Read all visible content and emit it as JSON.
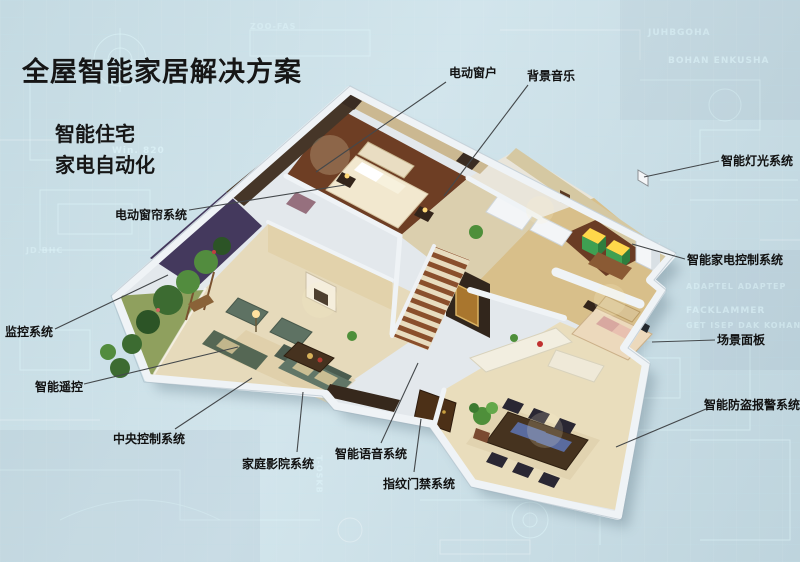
{
  "title": {
    "text": "全屋智能家居解决方案"
  },
  "subtitle": {
    "line1": "智能住宅",
    "line2": "家电自动化"
  },
  "colors": {
    "background": "#cbe0e8",
    "text": "#161616",
    "callout_line": "#44484b",
    "house_wall_white": "#eff3f6",
    "wood_floor": "#6e3e24",
    "marble_floor": "#e6dabb",
    "sofa_green": "#5e7263",
    "appliance_green": "#3fa052",
    "blueprint_line": "#dff6fa"
  },
  "callouts": [
    {
      "id": "electric-window",
      "label": "电动窗户",
      "label_x": 449,
      "label_y": 64,
      "line": [
        446,
        82,
        316,
        172
      ]
    },
    {
      "id": "background-music",
      "label": "背景音乐",
      "label_x": 527,
      "label_y": 67,
      "line": [
        528,
        85,
        444,
        196
      ]
    },
    {
      "id": "smart-lighting-system",
      "label": "智能灯光系统",
      "label_x": 721,
      "label_y": 152,
      "line": [
        719,
        161,
        644,
        177
      ]
    },
    {
      "id": "smart-appliance-control",
      "label": "智能家电控制系统",
      "label_x": 687,
      "label_y": 251,
      "line": [
        685,
        259,
        632,
        244
      ]
    },
    {
      "id": "scene-panel",
      "label": "场景面板",
      "label_x": 717,
      "label_y": 331,
      "line": [
        715,
        340,
        652,
        342
      ]
    },
    {
      "id": "anti-theft-alarm",
      "label": "智能防盗报警系统",
      "label_x": 704,
      "label_y": 396,
      "line": [
        706,
        409,
        616,
        447
      ]
    },
    {
      "id": "electric-curtain-system",
      "label": "电动窗帘系统",
      "label_x": 115,
      "label_y": 206,
      "line": [
        189,
        210,
        345,
        185
      ]
    },
    {
      "id": "monitoring-system",
      "label": "监控系统",
      "label_x": 5,
      "label_y": 323,
      "line": [
        55,
        329,
        168,
        275
      ]
    },
    {
      "id": "smart-remote-control",
      "label": "智能遥控",
      "label_x": 35,
      "label_y": 378,
      "line": [
        84,
        384,
        238,
        347
      ]
    },
    {
      "id": "central-control-system",
      "label": "中央控制系统",
      "label_x": 113,
      "label_y": 430,
      "line": [
        175,
        429,
        252,
        378
      ]
    },
    {
      "id": "home-theater-system",
      "label": "家庭影院系统",
      "label_x": 242,
      "label_y": 455,
      "line": [
        297,
        452,
        303,
        392
      ]
    },
    {
      "id": "smart-voice-system",
      "label": "智能语音系统",
      "label_x": 335,
      "label_y": 445,
      "line": [
        381,
        443,
        418,
        363
      ]
    },
    {
      "id": "fingerprint-access",
      "label": "指纹门禁系统",
      "label_x": 383,
      "label_y": 475,
      "line": [
        414,
        472,
        421,
        419
      ]
    }
  ],
  "background": {
    "annotations": [
      {
        "t": "Win. 820",
        "x": 112,
        "y": 146,
        "s": 9,
        "o": 0.55,
        "r": 0
      },
      {
        "t": "JUHBGOHA",
        "x": 648,
        "y": 28,
        "s": 9,
        "o": 0.45,
        "r": 0
      },
      {
        "t": "BOHAN ENKUSHA",
        "x": 668,
        "y": 56,
        "s": 9,
        "o": 0.5,
        "r": 0
      },
      {
        "t": "ADAPTEL ADAPTEP",
        "x": 686,
        "y": 282,
        "s": 8,
        "o": 0.45,
        "r": 0
      },
      {
        "t": "FACKLAMMER",
        "x": 686,
        "y": 306,
        "s": 9,
        "o": 0.5,
        "r": 0
      },
      {
        "t": "GET ISEP DAK KOHAN",
        "x": 686,
        "y": 321,
        "s": 8,
        "o": 0.45,
        "r": 0
      },
      {
        "t": "ZOO-FAS",
        "x": 250,
        "y": 22,
        "s": 8,
        "o": 0.4,
        "r": 0
      },
      {
        "t": "JD.BHC",
        "x": 26,
        "y": 246,
        "s": 8,
        "o": 0.4,
        "r": 0
      },
      {
        "t": "T-OSKB",
        "x": 300,
        "y": 470,
        "s": 8,
        "o": 0.45,
        "r": 90
      }
    ]
  }
}
